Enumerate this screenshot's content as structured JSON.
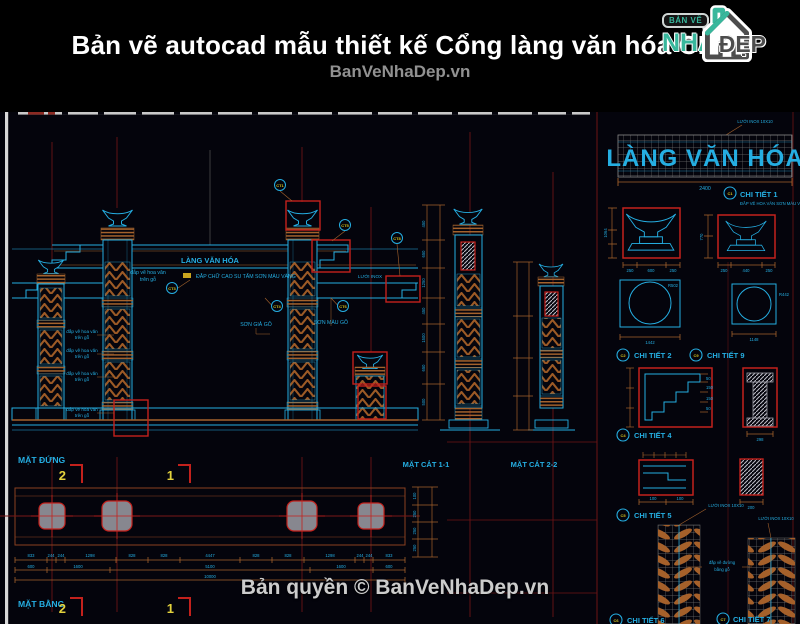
{
  "header": {
    "title": "Bản vẽ autocad mẫu thiết kế Cổng làng văn hóa CL5",
    "watermark": "BanVeNhaDep.vn",
    "logo": {
      "tagline": "BẢN VẼ",
      "name": "NHÀ",
      "suffix": "ĐẸP"
    }
  },
  "footer": {
    "copyright": "Bản quyền © BanVeNhaDep.vn"
  },
  "sign": {
    "text": "LÀNG VĂN HÓA",
    "width_dim": "2400",
    "note": "LƯỚI INOX 10X10"
  },
  "elevation": {
    "sign_text": "LÀNG VĂN HÓA",
    "label": "MẶT ĐỨNG",
    "notes": {
      "hoa_van": "đắp vẽ hoa văn",
      "tren_go": "trên gỗ",
      "chu_cao_su": "ĐẮP CHỮ CAO SU TẤM SƠN MÀU VÀNG",
      "luoi_inox": "LƯỚI INOX",
      "son_gia_go": "SƠN GIẢ GỖ",
      "son_mau_go": "SƠN MÀU GỖ"
    },
    "badges": [
      "CT1",
      "CT5",
      "CT8",
      "CT3",
      "CT4",
      "CT6"
    ],
    "vdims": [
      "450",
      "650",
      "1250",
      "450",
      "1500",
      "650",
      "500"
    ]
  },
  "sections": {
    "label_1": "MẶT CẮT 1-1",
    "label_2": "MẶT CẮT 2-2"
  },
  "plan": {
    "label": "MẶT BẰNG",
    "marker_2": "2",
    "marker_1": "1",
    "dims_row1": [
      "833",
      "244",
      "244",
      "1298",
      "828",
      "828",
      "4447",
      "828",
      "828",
      "1298",
      "244",
      "244",
      "833"
    ],
    "dims_row2": [
      "600",
      "1600",
      "5100",
      "1600",
      "600"
    ],
    "dims_row3": [
      "10000"
    ],
    "vdims": [
      "100",
      "250",
      "250",
      "250"
    ]
  },
  "details": {
    "d1": {
      "badge": "C1",
      "label": "CHI TIẾT 1",
      "note": "ĐẮP VẼ HOA VĂN SƠN MÀU VÀNG",
      "dims_a": [
        "250",
        "600",
        "250"
      ],
      "dims_b": [
        "250",
        "440",
        "250"
      ],
      "vdim_a": "1064",
      "vdim_b": "770"
    },
    "d2": {
      "badge": "C2",
      "label": "CHI TIẾT 2",
      "dim": "1442",
      "radius": "R502"
    },
    "d9": {
      "badge": "C9",
      "label": "CHI TIẾT 9",
      "dim": "1148",
      "radius": "R442"
    },
    "d4": {
      "badge": "C4",
      "label": "CHI TIẾT 4",
      "dim": "298",
      "step_dims": [
        "50",
        "150",
        "150",
        "50"
      ]
    },
    "d5": {
      "badge": "C5",
      "label": "CHI TIẾT 5",
      "dims": [
        "100",
        "100"
      ],
      "dim_b": "200"
    },
    "d6": {
      "badge": "C6",
      "label": "CHI TIẾT 6",
      "note": "LƯỚI INOX 10X10"
    },
    "d7": {
      "badge": "C7",
      "label": "CHI TIẾT 7",
      "note": "LƯỚI INOX 10X10",
      "mid_note_1": "đắp vẽ đường",
      "mid_note_2": "bằng gỗ"
    }
  },
  "colors": {
    "cyan": "#25aee2",
    "brown": "#a4622c",
    "red": "#c3211c",
    "dark_red": "#6e1414",
    "yellow": "#e3d23d",
    "teal": "#38b79c"
  }
}
